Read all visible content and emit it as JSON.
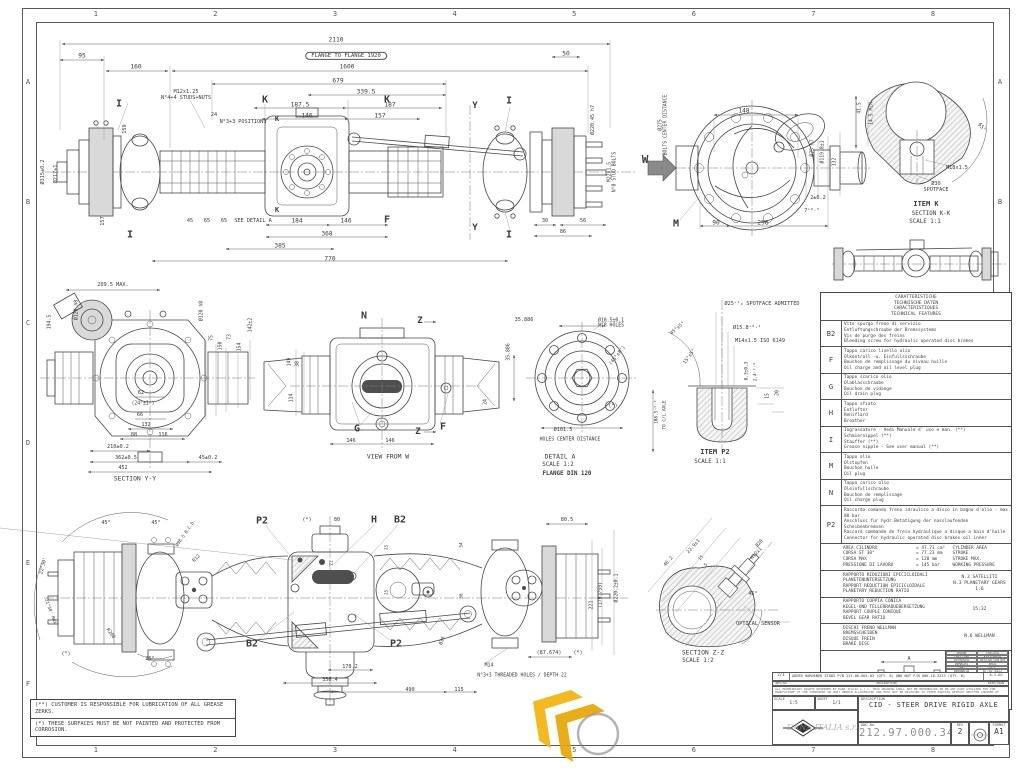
{
  "sheet": {
    "line_color": "#474747",
    "accent_yellow": "#F2B30B",
    "grid_cols": [
      "1",
      "2",
      "3",
      "4",
      "5",
      "6",
      "7",
      "8"
    ],
    "grid_rows": [
      "A",
      "B",
      "C",
      "D",
      "E",
      "F"
    ]
  },
  "dim_labels": [
    {
      "t": "2110",
      "x": 336,
      "y": 41
    },
    {
      "t": "FLANGE TO FLANGE 1920",
      "x": 346,
      "y": 56,
      "s": 5.5,
      "o": 1
    },
    {
      "t": "95",
      "x": 82,
      "y": 57
    },
    {
      "t": "160",
      "x": 136,
      "y": 68
    },
    {
      "t": "1600",
      "x": 347,
      "y": 68
    },
    {
      "t": "679",
      "x": 338,
      "y": 82
    },
    {
      "t": "339.5",
      "x": 366,
      "y": 93
    },
    {
      "t": "50",
      "x": 566,
      "y": 55
    },
    {
      "t": "M12x1.25\nN°4+4 STUDS+NUTS",
      "x": 186,
      "y": 96,
      "s": 5.2
    },
    {
      "t": "I",
      "x": 119,
      "y": 104,
      "s": 10,
      "b": 1
    },
    {
      "t": "24",
      "x": 214,
      "y": 116,
      "s": 5.2
    },
    {
      "t": "N°3+3 POSITIONS",
      "x": 243,
      "y": 123,
      "s": 5.2
    },
    {
      "t": "K",
      "x": 265,
      "y": 100,
      "s": 10,
      "b": 1
    },
    {
      "t": "K",
      "x": 387,
      "y": 100,
      "s": 10,
      "b": 1
    },
    {
      "t": "187.5",
      "x": 300,
      "y": 106
    },
    {
      "t": "187",
      "x": 390,
      "y": 106
    },
    {
      "t": "146",
      "x": 307,
      "y": 117
    },
    {
      "t": "157",
      "x": 380,
      "y": 117
    },
    {
      "t": "Y",
      "x": 475,
      "y": 106,
      "s": 9,
      "b": 1
    },
    {
      "t": "Y",
      "x": 475,
      "y": 228,
      "s": 9,
      "b": 1
    },
    {
      "t": "I",
      "x": 509,
      "y": 101,
      "s": 10,
      "b": 1
    },
    {
      "t": "I",
      "x": 509,
      "y": 235,
      "s": 10,
      "b": 1
    },
    {
      "t": "K",
      "x": 277,
      "y": 120,
      "s": 7,
      "b": 1
    },
    {
      "t": "K",
      "x": 277,
      "y": 211,
      "s": 7,
      "b": 1
    },
    {
      "t": "F",
      "x": 387,
      "y": 220,
      "s": 10,
      "b": 1
    },
    {
      "t": "SEE DETAIL A",
      "x": 253,
      "y": 222,
      "s": 5.2
    },
    {
      "t": "45",
      "x": 190,
      "y": 222,
      "s": 5.2
    },
    {
      "t": "65",
      "x": 207,
      "y": 222,
      "s": 5.2
    },
    {
      "t": "65",
      "x": 224,
      "y": 222,
      "s": 5.2
    },
    {
      "t": "184",
      "x": 297,
      "y": 222
    },
    {
      "t": "146",
      "x": 346,
      "y": 222
    },
    {
      "t": "368",
      "x": 327,
      "y": 235
    },
    {
      "t": "385",
      "x": 280,
      "y": 247
    },
    {
      "t": "770",
      "x": 330,
      "y": 260
    },
    {
      "t": "157",
      "x": 104,
      "y": 221,
      "r": -90,
      "s": 5.2
    },
    {
      "t": "I",
      "x": 130,
      "y": 235,
      "s": 10,
      "b": 1
    },
    {
      "t": "159",
      "x": 126,
      "y": 129,
      "r": -90,
      "s": 5.2
    },
    {
      "t": "Ø315±0.2",
      "x": 44,
      "y": 172,
      "r": -90,
      "s": 5.2
    },
    {
      "t": "Ø217±1",
      "x": 57,
      "y": 174,
      "r": -90,
      "s": 5.2
    },
    {
      "t": "Ø220.45 h7",
      "x": 594,
      "y": 120,
      "r": -90,
      "s": 5
    },
    {
      "t": "M22x1.5\nN°8 STUD BOLTS",
      "x": 613,
      "y": 172,
      "r": -90,
      "s": 4.8
    },
    {
      "t": "30",
      "x": 545,
      "y": 222,
      "s": 5.2
    },
    {
      "t": "56",
      "x": 583,
      "y": 222,
      "s": 5.2
    },
    {
      "t": "86",
      "x": 563,
      "y": 233,
      "s": 5.2
    },
    {
      "t": "W",
      "x": 645,
      "y": 160,
      "s": 11,
      "b": 1
    },
    {
      "t": "148",
      "x": 744,
      "y": 112
    },
    {
      "t": "Ø275\nBOLTS CENTER DISTANCE",
      "x": 664,
      "y": 125,
      "r": -90,
      "s": 4.8
    },
    {
      "t": "Ø75 h7",
      "x": 813,
      "y": 148,
      "r": -90,
      "s": 4.8
    },
    {
      "t": "Ø119.8±1",
      "x": 823,
      "y": 152,
      "r": -90,
      "s": 4.8
    },
    {
      "t": "132",
      "x": 835,
      "y": 162,
      "r": -90,
      "s": 4.8
    },
    {
      "t": "2±0.2",
      "x": 818,
      "y": 199,
      "s": 5.2
    },
    {
      "t": "7⁺⁰·⁵",
      "x": 812,
      "y": 212,
      "s": 5.2
    },
    {
      "t": "90",
      "x": 716,
      "y": 224
    },
    {
      "t": "296",
      "x": 763,
      "y": 224
    },
    {
      "t": "M",
      "x": 676,
      "y": 224,
      "s": 10,
      "b": 1
    },
    {
      "t": "41.5",
      "x": 860,
      "y": 108,
      "r": -90,
      "s": 4.8
    },
    {
      "t": "14.5 MIN.",
      "x": 872,
      "y": 112,
      "r": -90,
      "s": 4.8
    },
    {
      "t": "65°",
      "x": 981,
      "y": 128,
      "r": 50,
      "s": 5.2
    },
    {
      "t": "M18x1.5",
      "x": 957,
      "y": 169,
      "s": 5.2
    },
    {
      "t": "Ø30\nSPOTFACE",
      "x": 936,
      "y": 188,
      "s": 5.2
    },
    {
      "t": "ITEM K",
      "x": 926,
      "y": 205,
      "s": 7,
      "b": 1
    },
    {
      "t": "SECTION K-K",
      "x": 931,
      "y": 214,
      "s": 5.8
    },
    {
      "t": "SCALE 1:1",
      "x": 925,
      "y": 222,
      "s": 5.8
    },
    {
      "t": "209.5 MAX.",
      "x": 113,
      "y": 286,
      "s": 5.2
    },
    {
      "t": "194.5",
      "x": 50,
      "y": 322,
      "r": -90,
      "s": 4.8
    },
    {
      "t": "Ø120 h8",
      "x": 77,
      "y": 310,
      "r": -90,
      "s": 4.8
    },
    {
      "t": "Ø120 h8",
      "x": 202,
      "y": 311,
      "r": -90,
      "s": 4.8
    },
    {
      "t": "75",
      "x": 212,
      "y": 338,
      "r": -90,
      "s": 4.8
    },
    {
      "t": "150",
      "x": 221,
      "y": 346,
      "r": -90,
      "s": 4.8
    },
    {
      "t": "73",
      "x": 230,
      "y": 337,
      "r": -90,
      "s": 4.8
    },
    {
      "t": "154",
      "x": 240,
      "y": 347,
      "r": -90,
      "s": 4.8
    },
    {
      "t": "142±2",
      "x": 251,
      "y": 325,
      "r": -90,
      "s": 4.8
    },
    {
      "t": "62",
      "x": 141,
      "y": 394,
      "s": 5.2
    },
    {
      "t": "(24°±1°)",
      "x": 143,
      "y": 404,
      "s": 4.8
    },
    {
      "t": "66",
      "x": 140,
      "y": 416,
      "s": 5.2
    },
    {
      "t": "132",
      "x": 146,
      "y": 426,
      "s": 5.2
    },
    {
      "t": "88",
      "x": 134,
      "y": 436,
      "s": 5.2
    },
    {
      "t": "116",
      "x": 163,
      "y": 436,
      "s": 5.2
    },
    {
      "t": "210±0.2",
      "x": 118,
      "y": 448,
      "s": 5.2
    },
    {
      "t": "362±0.5",
      "x": 126,
      "y": 459,
      "s": 5.2
    },
    {
      "t": "45±0.2",
      "x": 208,
      "y": 459,
      "s": 5.2
    },
    {
      "t": "452",
      "x": 123,
      "y": 469,
      "s": 5.2
    },
    {
      "t": "SECTION Y-Y",
      "x": 135,
      "y": 479,
      "s": 6.4
    },
    {
      "t": "N",
      "x": 364,
      "y": 316,
      "s": 10,
      "b": 1
    },
    {
      "t": "Z",
      "x": 420,
      "y": 321,
      "s": 9,
      "b": 1
    },
    {
      "t": "Z",
      "x": 418,
      "y": 432,
      "s": 9,
      "b": 1
    },
    {
      "t": "149",
      "x": 290,
      "y": 362,
      "r": -90,
      "s": 4.8
    },
    {
      "t": "38",
      "x": 298,
      "y": 364,
      "r": -90,
      "s": 4.8
    },
    {
      "t": "114",
      "x": 292,
      "y": 398,
      "r": -90,
      "s": 4.8
    },
    {
      "t": "24",
      "x": 486,
      "y": 402,
      "r": -90,
      "s": 4.8
    },
    {
      "t": "G",
      "x": 357,
      "y": 429,
      "s": 10,
      "b": 1
    },
    {
      "t": "F",
      "x": 443,
      "y": 427,
      "s": 10,
      "b": 1
    },
    {
      "t": "146",
      "x": 351,
      "y": 442,
      "s": 5.2
    },
    {
      "t": "146",
      "x": 390,
      "y": 442,
      "s": 5.2
    },
    {
      "t": "VIEW FROM W",
      "x": 388,
      "y": 457,
      "s": 6.4
    },
    {
      "t": "35.886",
      "x": 524,
      "y": 321,
      "s": 5.2
    },
    {
      "t": "Ø10.5±0.1\nN°8 HOLES",
      "x": 611,
      "y": 324,
      "s": 4.8
    },
    {
      "t": "35.886",
      "x": 509,
      "y": 352,
      "r": -90,
      "s": 4.8
    },
    {
      "t": "(45°±8')",
      "x": 618,
      "y": 356,
      "r": -52,
      "s": 4.8
    },
    {
      "t": "(*)",
      "x": 613,
      "y": 407,
      "s": 5.2
    },
    {
      "t": "Ø101.5",
      "x": 563,
      "y": 431,
      "s": 5.2
    },
    {
      "t": "HOLES CENTER DISTANCE",
      "x": 570,
      "y": 440,
      "s": 4.8
    },
    {
      "t": "DETAIL A",
      "x": 560,
      "y": 457,
      "s": 6.4
    },
    {
      "t": "SCALE 1:2",
      "x": 558,
      "y": 465,
      "s": 5.8
    },
    {
      "t": "FLANGE DIN 120",
      "x": 567,
      "y": 474,
      "s": 5.8,
      "b": 1
    },
    {
      "t": "Ø25⁺¹₀ SPOTFACE ADMITTED",
      "x": 762,
      "y": 305,
      "s": 5.2
    },
    {
      "t": "Ø15.8⁺⁰·¹",
      "x": 747,
      "y": 329,
      "s": 5.2
    },
    {
      "t": "M14x1.5 ISO 6149",
      "x": 760,
      "y": 342,
      "s": 5.2
    },
    {
      "t": "45°±5°",
      "x": 678,
      "y": 329,
      "r": -40,
      "s": 4.8
    },
    {
      "t": "15°±5°",
      "x": 690,
      "y": 357,
      "r": -55,
      "s": 4.8
    },
    {
      "t": "0.3±0.3",
      "x": 748,
      "y": 371,
      "r": -90,
      "s": 4.4
    },
    {
      "t": "2.4⁺⁰·⁴",
      "x": 757,
      "y": 372,
      "r": -90,
      "s": 4.4
    },
    {
      "t": "15",
      "x": 768,
      "y": 396,
      "r": -90,
      "s": 4.8
    },
    {
      "t": "20",
      "x": 778,
      "y": 393,
      "r": -90,
      "s": 4.8
    },
    {
      "t": "108.5⁺⁰·³",
      "x": 658,
      "y": 412,
      "r": -90,
      "s": 4.4
    },
    {
      "t": "TO C/L AXLE",
      "x": 666,
      "y": 415,
      "r": -90,
      "s": 4.4
    },
    {
      "t": "ITEM P2",
      "x": 715,
      "y": 453,
      "s": 7,
      "b": 1
    },
    {
      "t": "SCALE 1:1",
      "x": 710,
      "y": 462,
      "s": 5.8
    },
    {
      "t": "P2",
      "x": 262,
      "y": 521,
      "s": 10,
      "b": 1
    },
    {
      "t": "H",
      "x": 374,
      "y": 520,
      "s": 10,
      "b": 1
    },
    {
      "t": "B2",
      "x": 400,
      "y": 520,
      "s": 10,
      "b": 1
    },
    {
      "t": "B2",
      "x": 252,
      "y": 644,
      "s": 10,
      "b": 1
    },
    {
      "t": "P2",
      "x": 396,
      "y": 644,
      "s": 10,
      "b": 1
    },
    {
      "t": "(*)",
      "x": 307,
      "y": 521,
      "s": 5.2
    },
    {
      "t": "80",
      "x": 337,
      "y": 521,
      "s": 5.2
    },
    {
      "t": "45°",
      "x": 106,
      "y": 524,
      "s": 5.2
    },
    {
      "t": "45°",
      "x": 156,
      "y": 524,
      "s": 5.2
    },
    {
      "t": "Ø98.5 B.C.D.",
      "x": 187,
      "y": 534,
      "r": -55,
      "s": 4.4
    },
    {
      "t": "22°30'",
      "x": 44,
      "y": 566,
      "r": -75,
      "s": 4.8
    },
    {
      "t": "21°30' MAX",
      "x": 49,
      "y": 612,
      "r": 70,
      "s": 4.4
    },
    {
      "t": "R12",
      "x": 197,
      "y": 559,
      "r": -45,
      "s": 4.8
    },
    {
      "t": "R200",
      "x": 110,
      "y": 634,
      "r": 55,
      "s": 4.8
    },
    {
      "t": "26°",
      "x": 150,
      "y": 660,
      "s": 5.2
    },
    {
      "t": "(*)",
      "x": 66,
      "y": 655,
      "s": 5.2
    },
    {
      "t": "Ø36",
      "x": 443,
      "y": 641,
      "r": -70,
      "s": 4.8
    },
    {
      "t": "21",
      "x": 333,
      "y": 563,
      "r": -90,
      "s": 4.4
    },
    {
      "t": "15",
      "x": 388,
      "y": 548,
      "r": -80,
      "s": 4.4
    },
    {
      "t": "54",
      "x": 463,
      "y": 545,
      "r": -90,
      "s": 4.4
    },
    {
      "t": "15",
      "x": 388,
      "y": 593,
      "r": -80,
      "s": 4.4
    },
    {
      "t": "56",
      "x": 463,
      "y": 596,
      "r": -90,
      "s": 4.4
    },
    {
      "t": "178.2",
      "x": 350,
      "y": 668,
      "s": 5.2
    },
    {
      "t": "356.4",
      "x": 330,
      "y": 681,
      "s": 5.2
    },
    {
      "t": "490",
      "x": 410,
      "y": 691,
      "s": 5.2
    },
    {
      "t": "115",
      "x": 459,
      "y": 691,
      "s": 5.2
    },
    {
      "t": "M14",
      "x": 489,
      "y": 666,
      "s": 4.8
    },
    {
      "t": "N°3+3 THREADED HOLES / DEPTH 22",
      "x": 522,
      "y": 676,
      "s": 4.8
    },
    {
      "t": "80.5",
      "x": 567,
      "y": 521,
      "s": 5.2
    },
    {
      "t": "Ø220.2±0.1",
      "x": 617,
      "y": 588,
      "r": -90,
      "s": 4.8
    },
    {
      "t": "(179.759)",
      "x": 601,
      "y": 595,
      "r": -90,
      "s": 4.8
    },
    {
      "t": "221",
      "x": 592,
      "y": 605,
      "r": -90,
      "s": 4.8
    },
    {
      "t": "(87.674)",
      "x": 549,
      "y": 654,
      "s": 5.2
    },
    {
      "t": "(*)",
      "x": 578,
      "y": 654,
      "s": 5.2
    },
    {
      "t": "46.2",
      "x": 669,
      "y": 562,
      "r": -48,
      "s": 4.8
    },
    {
      "t": "22.9±1",
      "x": 694,
      "y": 547,
      "r": -48,
      "s": 4.8
    },
    {
      "t": "15",
      "x": 702,
      "y": 559,
      "r": -48,
      "s": 4.4
    },
    {
      "t": "5",
      "x": 707,
      "y": 566,
      "r": -48,
      "s": 4.4
    },
    {
      "t": "Ø20",
      "x": 760,
      "y": 544,
      "r": -48,
      "s": 4.8
    },
    {
      "t": "M12x1",
      "x": 757,
      "y": 554,
      "r": -48,
      "s": 4.8
    },
    {
      "t": "45°",
      "x": 753,
      "y": 595,
      "s": 5.2
    },
    {
      "t": "OPTICAL SENSOR",
      "x": 758,
      "y": 625,
      "s": 5.2
    },
    {
      "t": "SECTION Z-Z",
      "x": 703,
      "y": 653,
      "s": 6.4
    },
    {
      "t": "SCALE 1:2",
      "x": 698,
      "y": 661,
      "s": 5.8
    }
  ],
  "features_table": {
    "header": [
      "CARATTERISTICHE",
      "TECHNISCHE DATEN",
      "CARACTERISTIQUES",
      "TECHNICAL FEATURES"
    ],
    "rows": [
      {
        "key": "B2",
        "lines": [
          "Vite spurgo freno di servizio",
          "Entluftungschraube der Bremssystems",
          "Vis de purge des freins",
          "Bleeding screw for hydraulic operated disc brakes"
        ]
      },
      {
        "key": "F",
        "lines": [
          "Tappo carico livello olio",
          "Olkontroll -u. Einfullsschraube",
          "Bouchon de remplissage du niveau huille",
          "Oil charge and oil level plug"
        ]
      },
      {
        "key": "G",
        "lines": [
          "Tappo scarico olio",
          "Olablasschraube",
          "Bouchon de vidange",
          "Oil drain plug"
        ]
      },
      {
        "key": "H",
        "lines": [
          "Tappo sfiato",
          "Entlufter",
          "Reniflard",
          "Breather"
        ]
      },
      {
        "key": "I",
        "lines": [
          "Ingrassatore - Vedi Manuale d' uso e man. (**)",
          "Schmiernippel (**)",
          "Stauffer (**)",
          "Grease nipple - See user manual (**)"
        ]
      },
      {
        "key": "M",
        "lines": [
          "Tappo olio",
          "Olstopfen",
          "Bouchon huile",
          "Oil plug"
        ]
      },
      {
        "key": "N",
        "lines": [
          "Tappo carico olio",
          "Oleinfullschraube",
          "Bouchon de remplissage",
          "Oil charge plug"
        ]
      },
      {
        "key": "P2",
        "lines": [
          "Raccordo comando freno idraulico a disco in bagno d'olio - max 80 bar",
          "Anschluss fur hydr.Betatigung der nasslaufenden Scheibenbremsen",
          "Raccord commande de frein hydraulique a disque a bain d'huile",
          "Connector for hydraulic operated disc brakes oil inner"
        ]
      }
    ],
    "cylinder_specs": [
      [
        "AREA CILINDRO",
        "= 47.71 cm²",
        "CYLINDER AREA"
      ],
      [
        "CORSA ST 30°",
        "= 77.23 mm",
        "STROKE"
      ],
      [
        "CORSA MAX",
        "= 120 mm",
        "STROKE MAX."
      ],
      [
        "PRESSIONE DI LAVORO",
        "= 145 bar",
        "WORKING PRESSURE"
      ]
    ],
    "ratio_rows": [
      {
        "lines": [
          "RAPPORTO RIDUZIONI EPICICLOIDALI",
          "PLANETENUNTERSETZUNG",
          "RAPPORT REDUCTION EPICICLOIDALE",
          "PLANETARY REDUCTION RATIO"
        ],
        "value": "N.3 SATELLITI\nN.3 PLANETARY GEARS\n1:6"
      },
      {
        "lines": [
          "RAPPORTO COPPIA CONICA",
          "KEGEL-UND TELLERRADUEBERSETZUNG",
          "RAPPORT COUPLE CONIQUE",
          "BEVEL GEAR RATIO"
        ],
        "value": "15:32"
      },
      {
        "lines": [
          "DISCHI FRENO WELLMAN",
          "BREMSSCHEIBEN",
          "DISQUE FREIN",
          "BRAKE DISC"
        ],
        "value": "N.6 WELLMAN"
      }
    ],
    "toe_in": {
      "label": "TOE IN SETTING",
      "diagram_top": "A",
      "diagram_bottom": "B",
      "value": "R=500  A-B = 0 +/- 2.5mm"
    }
  },
  "notes": [
    "(**) CUSTOMER IS RESPONSIBLE FOR LUBRICATION OF ALL GREASE ZERKS.",
    "(*) THESE SURFACES MUST BE NOT PAINTED AND PROTECTED FROM CORROSION."
  ],
  "title_block": {
    "people_grid": [
      [
        "DRAWN",
        "CHECKED"
      ],
      [
        "CRESTINA",
        "KASTURKAR"
      ],
      [
        "APPROVED",
        "DESIGN CENTER"
      ],
      [
        "DEMACHI",
        "ARCO"
      ],
      [
        "DWG",
        "DATE"
      ],
      [
        "00000618",
        "07-02-2022"
      ]
    ],
    "revision": {
      "rev": "2/1",
      "description": "ADDED HARDENED STUDS P/N 223.06.001.03 (QTY. 8) AND NUT P/N 006.18.3233 (QTY. 8)",
      "sign": "A.1.AG"
    },
    "rev_headers": {
      "rev": "REV/SH",
      "description": "DESCRIPTION",
      "sign": "DATE/SIGN"
    },
    "proprietary": "ALL PROPRIETARY RIGHTS RESERVED BY DANA ITALIA s.r.l. THIS DRAWING SHALL NOT BE REPRODUCED IN OR ANY PART UTILIZED FOR THE MANUFACTURE OF THE COMPONENT OR UNIT HEREIN ILLUSTRATED AND MUST NOT BE RELEASED TO OTHER PARTIES WITHOUT WRITTEN CONSENT OF DANA. ANY INFRINGEMENT WILL BE LEGALLY PURSUED",
    "scale_label": "SCALE",
    "scale": "1:5",
    "sheet_label": "SHEET",
    "sheet": "1/1",
    "description_label": "DESCRIPTION",
    "title": "CID - STEER DRIVE RIGID AXLE",
    "company": "DANA ITALIA s.r.l",
    "dwg_no_label": "DWG No.",
    "dwg_no": "212.97.000.348",
    "rev_label": "REV",
    "rev": "2",
    "format_label": "FORMAT",
    "format": "A1"
  }
}
